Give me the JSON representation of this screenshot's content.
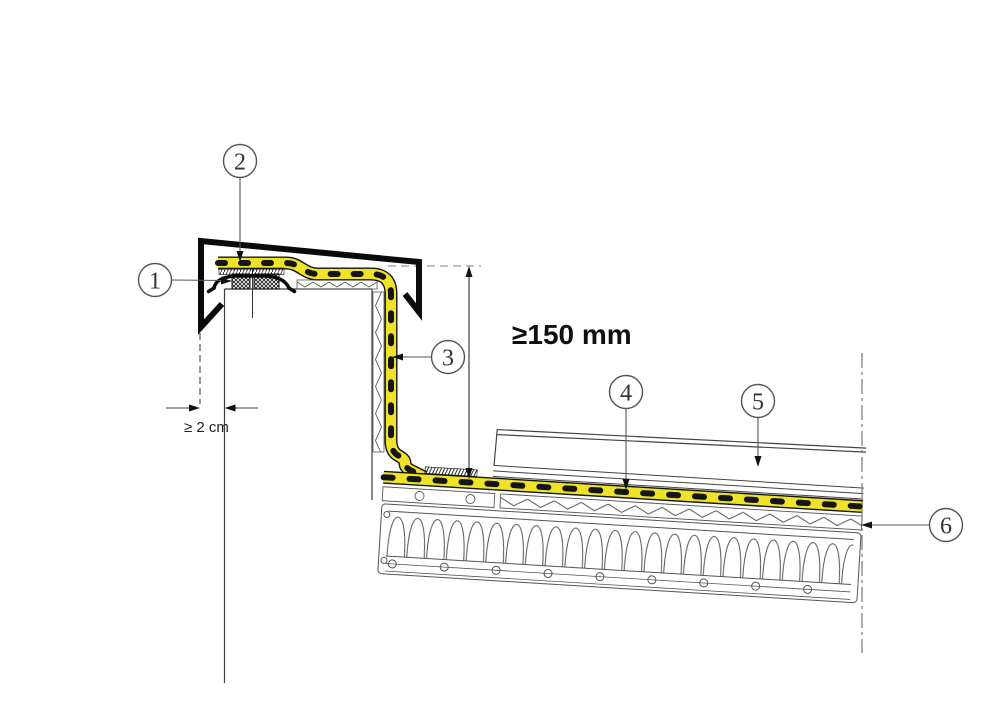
{
  "diagram": {
    "type": "construction-detail-section",
    "callouts": [
      {
        "id": 1,
        "label": "1"
      },
      {
        "id": 2,
        "label": "2"
      },
      {
        "id": 3,
        "label": "3"
      },
      {
        "id": 4,
        "label": "4"
      },
      {
        "id": 5,
        "label": "5"
      },
      {
        "id": 6,
        "label": "6"
      }
    ],
    "dimensions": {
      "membrane_upstand_min": "≥150 mm",
      "coping_clearance_min": "≥ 2 cm"
    },
    "colors": {
      "membrane_yellow": "#efe32a",
      "drawing_line": "#3d3d3d",
      "coping_black": "#0a0a0a"
    }
  }
}
